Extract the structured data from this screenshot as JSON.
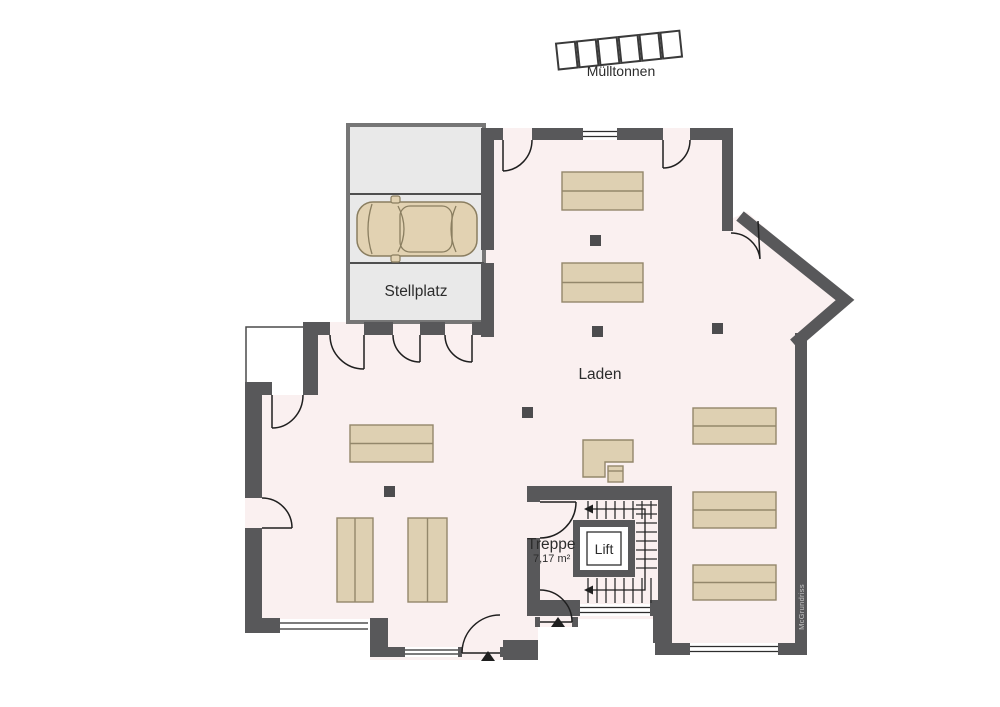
{
  "floor_plan": {
    "rooms": [
      {
        "id": "laden",
        "label": "Laden"
      },
      {
        "id": "treppe",
        "label": "Treppe",
        "area": "7,17 m²"
      },
      {
        "id": "lift",
        "label": "Lift"
      },
      {
        "id": "stellplatz",
        "label": "Stellplatz"
      }
    ],
    "outdoor": {
      "label": "Mülltonnen",
      "bin_count": 6
    },
    "watermark": "McGrundriss",
    "colors": {
      "wall": "#58585a",
      "floor": "#faf0f0",
      "furniture": "#ded0b2",
      "furniture_border": "#93876b",
      "stellplatz_fill": "#e9e9e9",
      "stellplatz_border": "#767676",
      "car_body": "#e2d2b2",
      "column": "#4c4c4e",
      "thin_line": "#2e2e2e",
      "watermark_text": "#c6c6c6"
    }
  }
}
